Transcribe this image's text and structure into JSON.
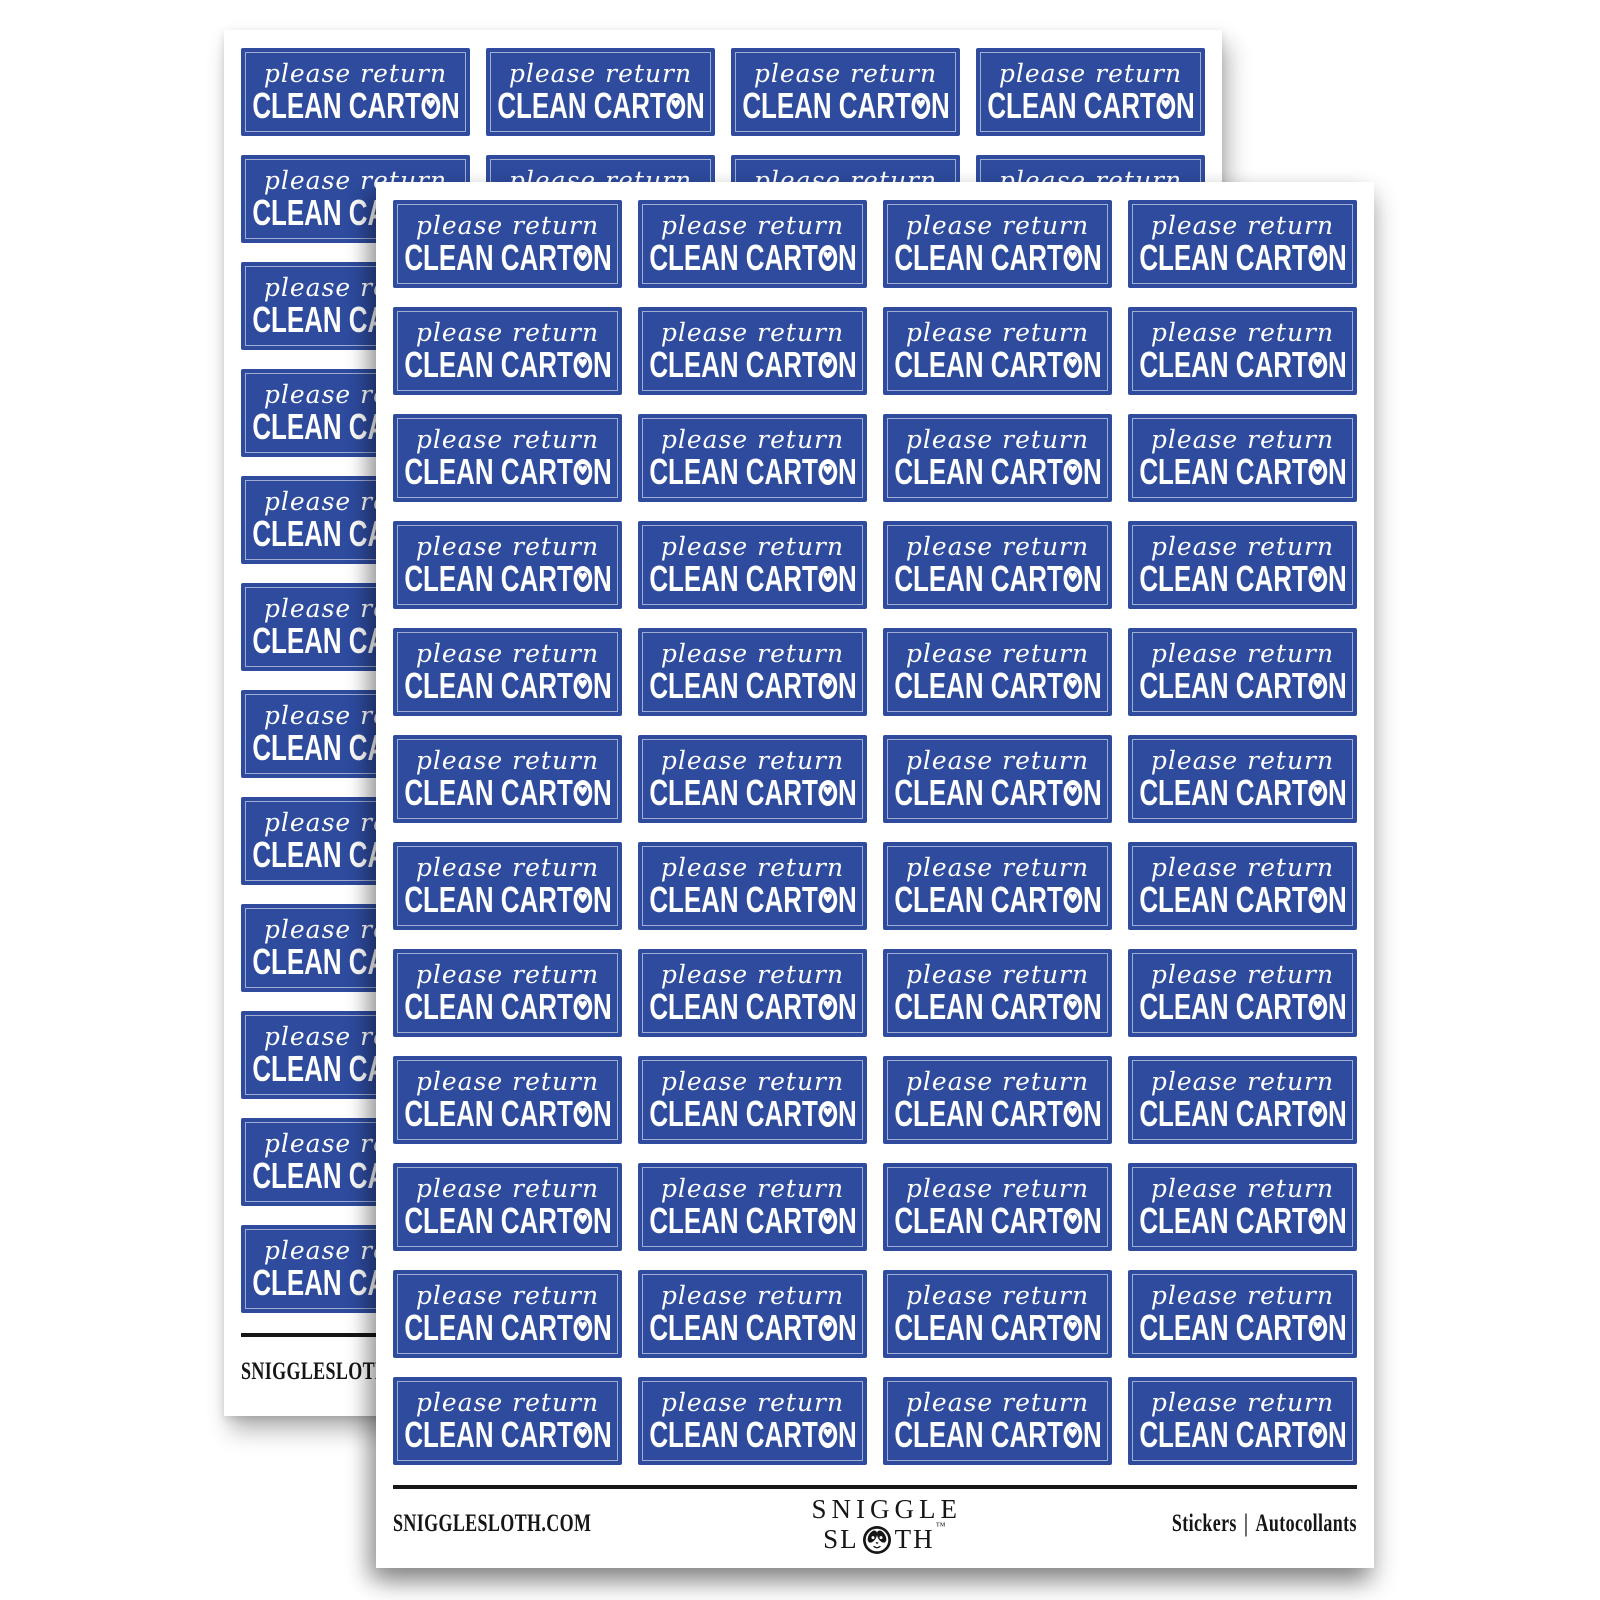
{
  "colors": {
    "page_bg": "#ffffff",
    "sheet_bg": "#ffffff",
    "sticker_blue": "#2e4b9e",
    "sticker_line": "rgba(255,255,255,0.55)",
    "sticker_text": "#ffffff",
    "footer_ink": "#161616"
  },
  "sheet": {
    "count": 2,
    "grid": {
      "columns": 4,
      "rows": 12
    },
    "sticker": {
      "line1": "please return",
      "line2_before": "CLEAN CART",
      "heart": "♥",
      "line2_after": "N"
    },
    "footer": {
      "website": "SNIGGLESLOTH.COM",
      "logo_line1": "SNIGGLE",
      "logo_line2_before": "SL",
      "logo_line2_after": "TH",
      "trademark": "™",
      "type_en": "Stickers",
      "separator": "|",
      "type_fr": "Autocollants"
    }
  }
}
